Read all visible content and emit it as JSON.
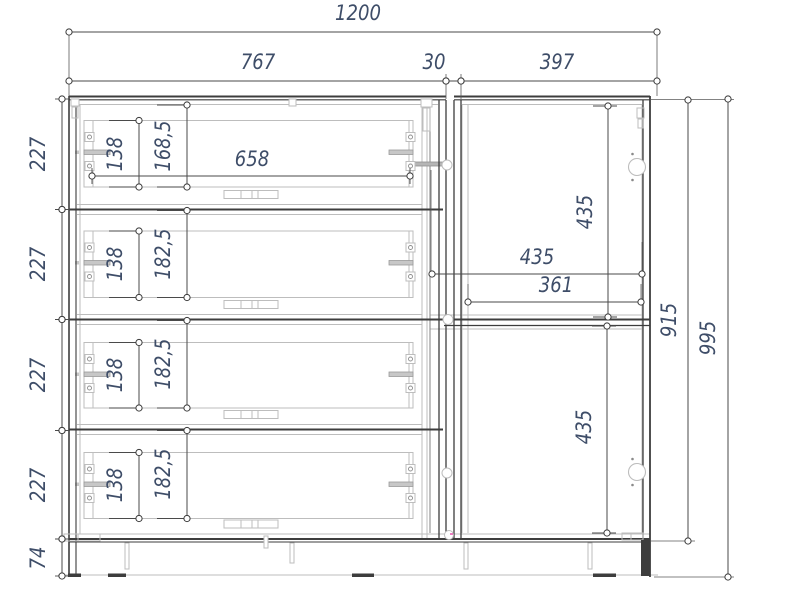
{
  "drawing": {
    "colors": {
      "background": "#ffffff",
      "line_dark": "#3d3d3d",
      "line_medium": "#8e8e8e",
      "line_light": "#bdbdbd",
      "dim_line": "#4a4a4a",
      "dim_text": "#3e4d68",
      "accent_mark": "#e85bb0"
    },
    "dimensions": [
      {
        "name": "overall-width",
        "label": "1200",
        "dir": "h",
        "x1": 69,
        "x2": 657,
        "y": 32,
        "tx": 358,
        "ty": 20
      },
      {
        "name": "drawer-module-width",
        "label": "767",
        "dir": "h",
        "x1": 69,
        "x2": 446,
        "y": 81,
        "tx": 258,
        "ty": 69
      },
      {
        "name": "module-gap-width",
        "label": "30",
        "dir": "h",
        "x1": 446,
        "x2": 461,
        "y": 81,
        "tx": 434,
        "ty": 69
      },
      {
        "name": "door-module-width",
        "label": "397",
        "dir": "h",
        "x1": 461,
        "x2": 657,
        "y": 81,
        "tx": 557,
        "ty": 69
      },
      {
        "name": "drawer-inner-width",
        "label": "658",
        "dir": "h",
        "x1": 92,
        "x2": 410,
        "y": 176,
        "tx": 252,
        "ty": 166,
        "end_dash": [
          -8,
          8
        ]
      },
      {
        "name": "door-width",
        "label": "435",
        "dir": "h",
        "x1": 432,
        "x2": 642,
        "y": 274,
        "tx": 537,
        "ty": 264
      },
      {
        "name": "door-inner-width",
        "label": "361",
        "dir": "h",
        "x1": 468,
        "x2": 641,
        "y": 302,
        "tx": 556,
        "ty": 292
      },
      {
        "name": "drawer-1-height",
        "label": "227",
        "dir": "v",
        "x": 62,
        "y1": 99,
        "y2": 209.5,
        "tx": 45,
        "ty": 154,
        "end_dash": [
          -7,
          8
        ]
      },
      {
        "name": "drawer-2-height",
        "label": "227",
        "dir": "v",
        "x": 62,
        "y1": 209.5,
        "y2": 319.5,
        "tx": 45,
        "ty": 264,
        "end_dash": [
          -7,
          8
        ]
      },
      {
        "name": "drawer-3-height",
        "label": "227",
        "dir": "v",
        "x": 62,
        "y1": 319.5,
        "y2": 430.5,
        "tx": 45,
        "ty": 375,
        "end_dash": [
          -7,
          8
        ]
      },
      {
        "name": "drawer-4-height",
        "label": "227",
        "dir": "v",
        "x": 62,
        "y1": 430.5,
        "y2": 539,
        "tx": 45,
        "ty": 485,
        "end_dash": [
          -7,
          8
        ]
      },
      {
        "name": "plinth-height",
        "label": "74",
        "dir": "v",
        "x": 62,
        "y1": 539,
        "y2": 576,
        "tx": 45,
        "ty": 558,
        "end_dash": [
          -7,
          8
        ]
      },
      {
        "name": "drawer-1-box-height",
        "label": "138",
        "dir": "v",
        "x": 139,
        "y1": 120.5,
        "y2": 187,
        "tx": 122,
        "ty": 154,
        "end_dash": [
          -30,
          3
        ]
      },
      {
        "name": "drawer-2-box-height",
        "label": "138",
        "dir": "v",
        "x": 139,
        "y1": 231,
        "y2": 297.5,
        "tx": 122,
        "ty": 264,
        "end_dash": [
          -30,
          3
        ]
      },
      {
        "name": "drawer-3-box-height",
        "label": "138",
        "dir": "v",
        "x": 139,
        "y1": 342.5,
        "y2": 408,
        "tx": 122,
        "ty": 375,
        "end_dash": [
          -30,
          3
        ]
      },
      {
        "name": "drawer-4-box-height",
        "label": "138",
        "dir": "v",
        "x": 139,
        "y1": 452.5,
        "y2": 518.5,
        "tx": 122,
        "ty": 485,
        "end_dash": [
          -30,
          3
        ]
      },
      {
        "name": "drawer-1-clear-height",
        "label": "168,5",
        "dir": "v",
        "x": 187,
        "y1": 105,
        "y2": 187,
        "tx": 170,
        "ty": 146,
        "end_dash": [
          -30,
          3
        ]
      },
      {
        "name": "drawer-2-clear-height",
        "label": "182,5",
        "dir": "v",
        "x": 187,
        "y1": 210.5,
        "y2": 297.5,
        "tx": 170,
        "ty": 254,
        "end_dash": [
          -30,
          3
        ]
      },
      {
        "name": "drawer-3-clear-height",
        "label": "182,5",
        "dir": "v",
        "x": 187,
        "y1": 320.5,
        "y2": 408,
        "tx": 170,
        "ty": 364,
        "end_dash": [
          -30,
          3
        ]
      },
      {
        "name": "drawer-4-clear-height",
        "label": "182,5",
        "dir": "v",
        "x": 187,
        "y1": 430.5,
        "y2": 518.5,
        "tx": 170,
        "ty": 474,
        "end_dash": [
          -30,
          3
        ]
      },
      {
        "name": "top-door-height",
        "label": "435",
        "dir": "v",
        "x": 608,
        "y1": 106,
        "y2": 317,
        "tx": 592,
        "ty": 212,
        "end_dash": [
          -15,
          9
        ]
      },
      {
        "name": "bottom-door-height",
        "label": "435",
        "dir": "v",
        "x": 607,
        "y1": 326,
        "y2": 533,
        "tx": 591,
        "ty": 427,
        "end_dash": [
          -15,
          9
        ]
      },
      {
        "name": "carcass-height",
        "label": "915",
        "dir": "v",
        "x": 688,
        "y1": 100,
        "y2": 541,
        "tx": 676,
        "ty": 320
      },
      {
        "name": "overall-height",
        "label": "995",
        "dir": "v",
        "x": 728,
        "y1": 99,
        "y2": 577,
        "tx": 715,
        "ty": 338
      }
    ]
  }
}
